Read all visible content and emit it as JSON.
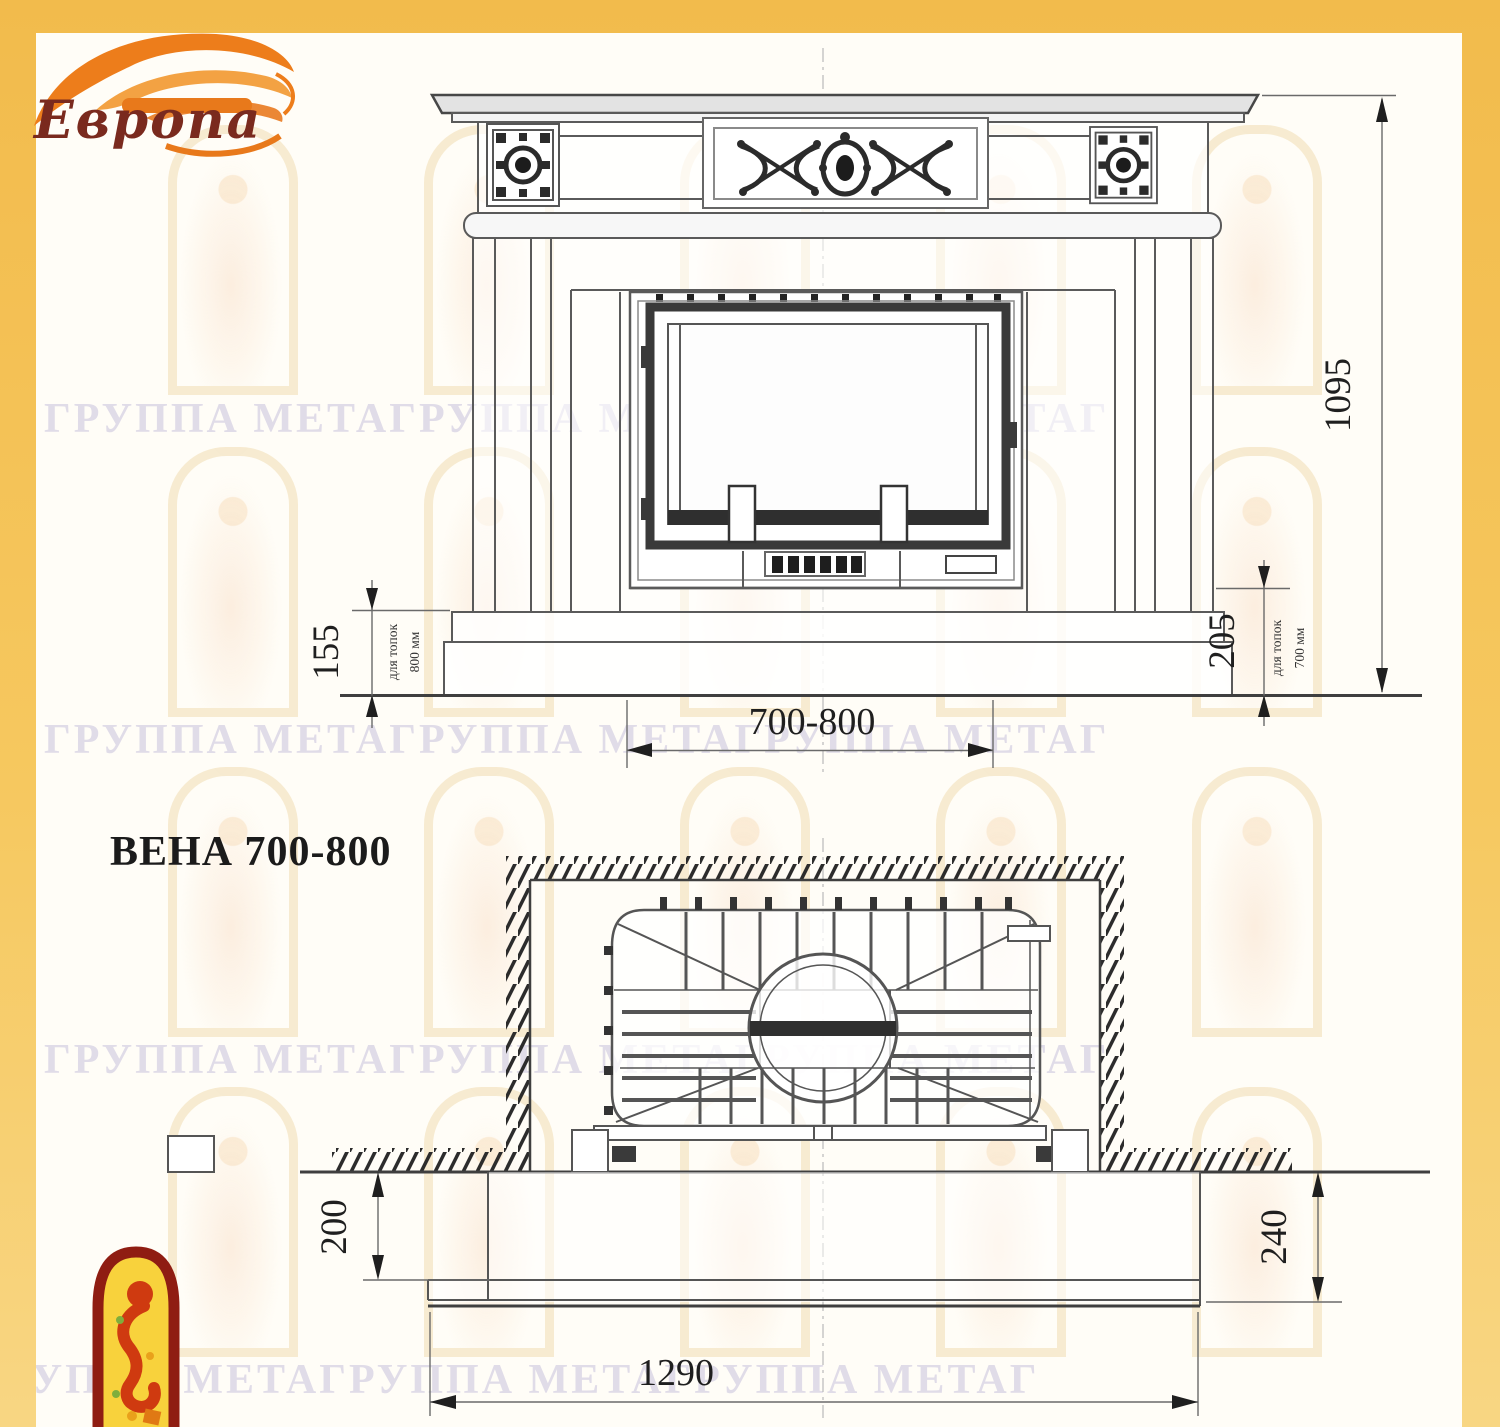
{
  "brand": {
    "logo_text": "Европа"
  },
  "title": {
    "model_label": "ВЕНА 700-800"
  },
  "watermark": {
    "text": "ГРУППА МЕТАГРУППА МЕТАГРУППА МЕТАГ"
  },
  "front_view": {
    "dims": {
      "total_height": "1095",
      "firebox_width_range": "700-800",
      "plinth_height_left": "155",
      "plinth_left_note_line1": "для топок",
      "plinth_left_note_line2": "800 мм",
      "plinth_height_right": "205",
      "plinth_right_note_line1": "для топок",
      "plinth_right_note_line2": "700 мм"
    }
  },
  "plan_view": {
    "dims": {
      "hearth_overhang_left": "200",
      "hearth_overhang_right": "240",
      "hearth_width": "1290"
    }
  },
  "colors": {
    "page_border_yellow": "#f5c45f",
    "flame_orange": "#ed7d1b",
    "logo_maroon": "#7a2a1e",
    "jester_red": "#cf3a10",
    "jester_yellow": "#f8d23c",
    "drawing_line_gray": "#555555"
  }
}
